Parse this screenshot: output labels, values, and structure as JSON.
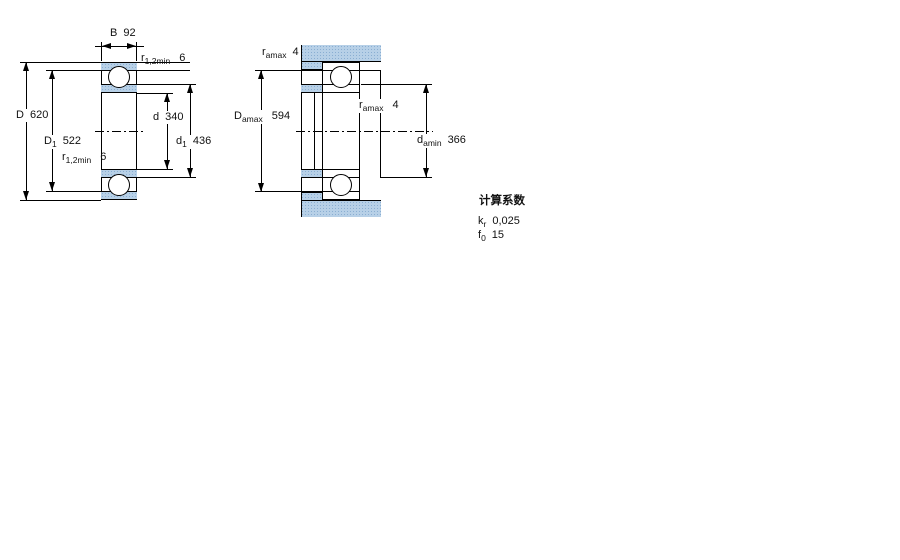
{
  "drawing": {
    "description": "bearing dimension drawing",
    "colors": {
      "background": "#ffffff",
      "line": "#000000",
      "section_fill": "#b7d0e7",
      "section_dot": "#8aaed2"
    },
    "left_view": {
      "name": "bearing-cross-section",
      "dims": {
        "B": {
          "symbol": "B",
          "value": "92"
        },
        "r_top": {
          "symbol": "r",
          "sub": "1,2min",
          "value": "6"
        },
        "D": {
          "symbol": "D",
          "value": "620"
        },
        "D1": {
          "symbol": "D",
          "sub": "1",
          "value": "522"
        },
        "d": {
          "symbol": "d",
          "value": "340"
        },
        "d1": {
          "symbol": "d",
          "sub": "1",
          "value": "436"
        },
        "r_bottom": {
          "symbol": "r",
          "sub": "1,2min",
          "value": "6"
        }
      }
    },
    "right_view": {
      "name": "abutment-and-fillet-dimensions",
      "dims": {
        "r_amax_left": {
          "symbol": "r",
          "sub": "amax",
          "value": "4"
        },
        "D_amax": {
          "symbol": "D",
          "sub": "amax",
          "value": "594"
        },
        "r_amax_right": {
          "symbol": "r",
          "sub": "amax",
          "value": "4"
        },
        "d_amin": {
          "symbol": "d",
          "sub": "amin",
          "value": "366"
        }
      }
    },
    "calculation_factors": {
      "title": "计算系数",
      "rows": [
        {
          "symbol": "k",
          "sub": "r",
          "value": "0,025"
        },
        {
          "symbol": "f",
          "sub": "0",
          "value": "15"
        }
      ]
    }
  }
}
